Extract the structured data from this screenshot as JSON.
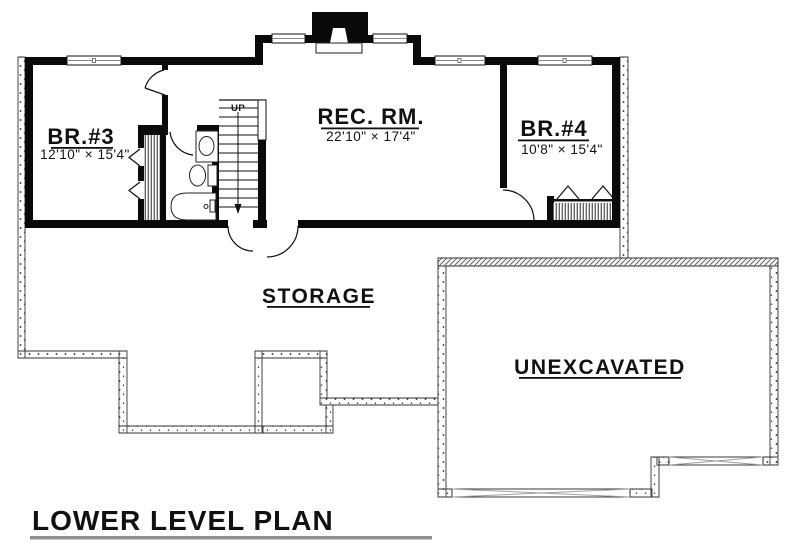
{
  "plan": {
    "title": "LOWER LEVEL PLAN",
    "rooms": {
      "br3": {
        "name": "BR.#3",
        "dims": "12'10\" × 15'4\""
      },
      "rec": {
        "name": "REC. RM.",
        "dims": "22'10\" × 17'4\""
      },
      "br4": {
        "name": "BR.#4",
        "dims": "10'8\" × 15'4\""
      },
      "storage": {
        "name": "STORAGE"
      },
      "unexcavated": {
        "name": "UNEXCAVATED"
      }
    },
    "stairs": {
      "up_label": "UP"
    },
    "colors": {
      "wall": "#0a0a0a",
      "background": "#ffffff",
      "title_underline": "#8f8f8f",
      "beam_line": "#a0a0a0",
      "foundation_line": "#333333"
    }
  }
}
